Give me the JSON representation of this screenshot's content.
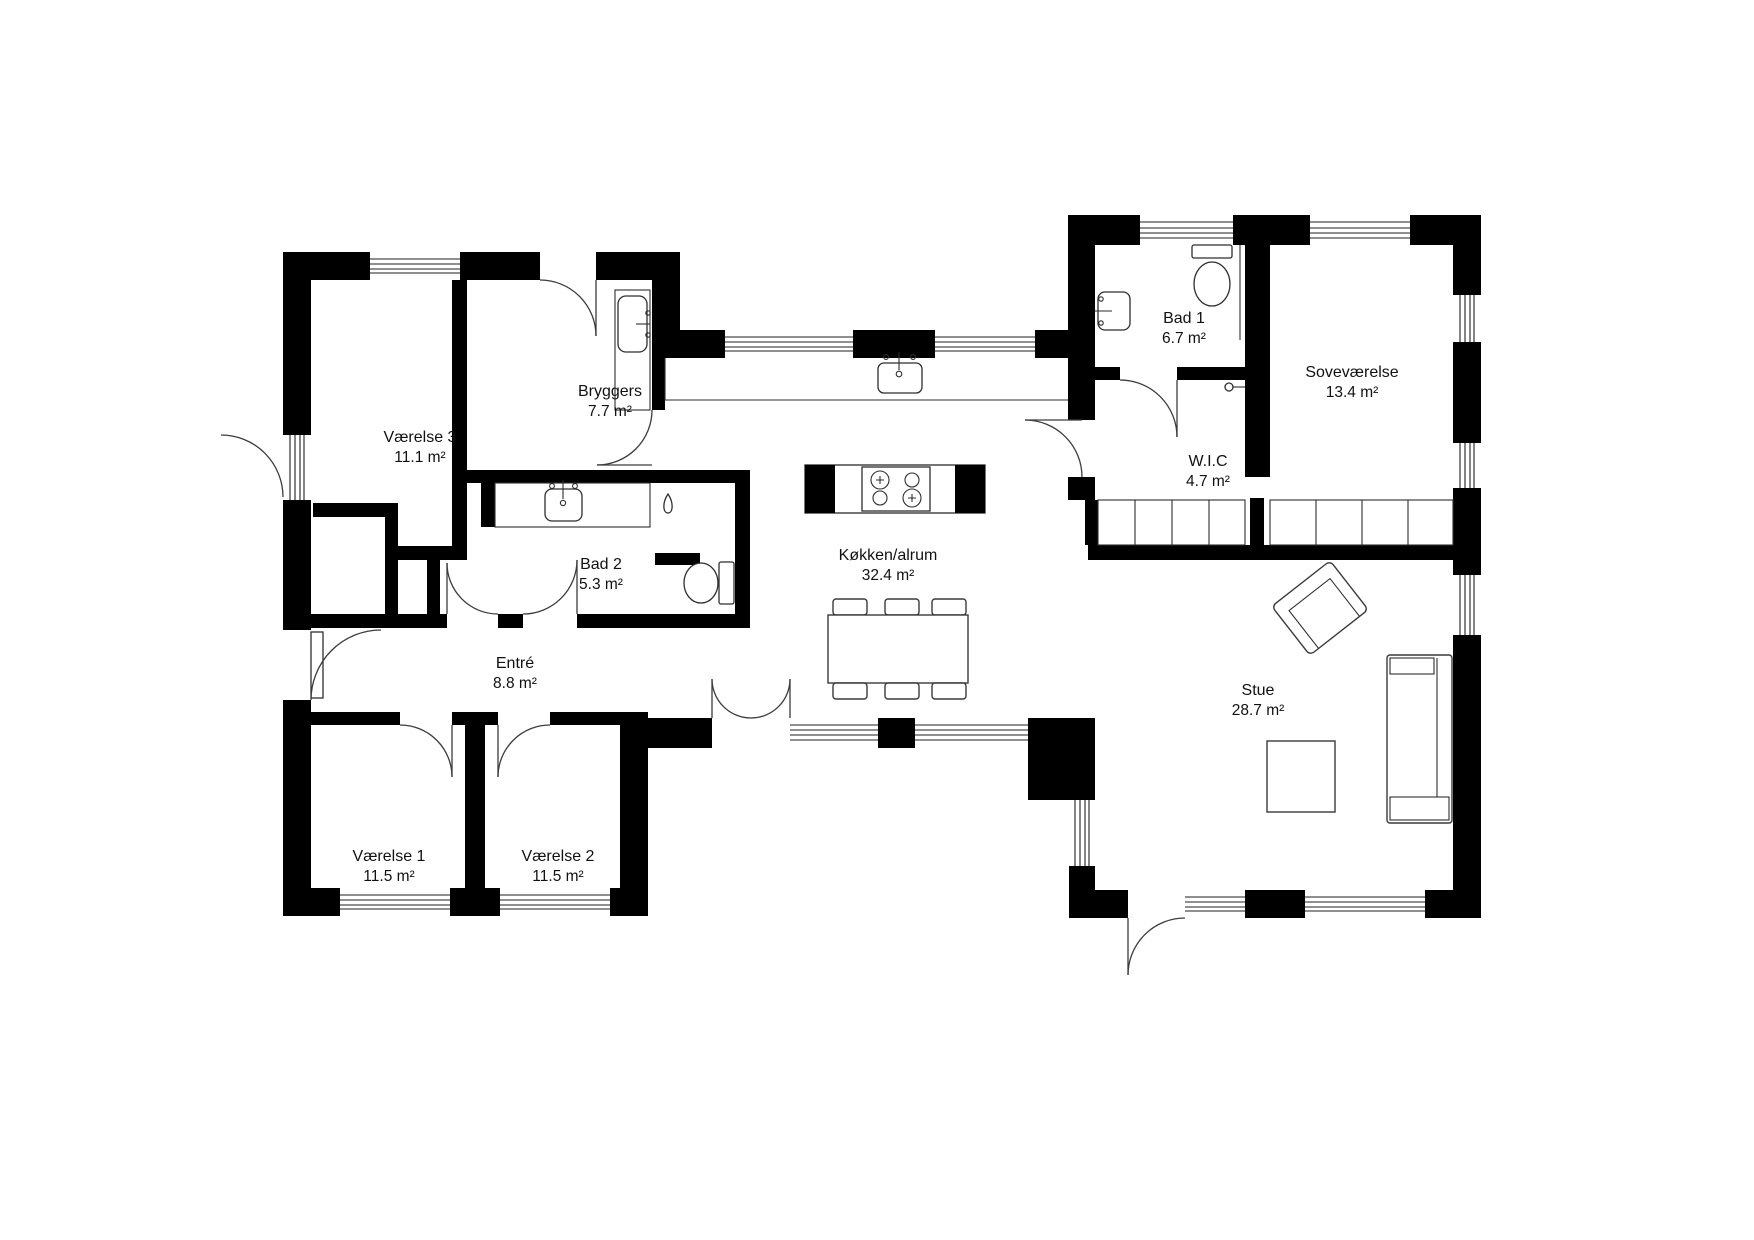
{
  "plan": {
    "title": "Floor plan",
    "wall_color": "#000000",
    "background_color": "#ffffff",
    "unit": "m²",
    "rooms": [
      {
        "id": "vaerelse3",
        "name": "Værelse 3",
        "area": "11.1 m²"
      },
      {
        "id": "bryggers",
        "name": "Bryggers",
        "area": "7.7 m²"
      },
      {
        "id": "bad2",
        "name": "Bad 2",
        "area": "5.3 m²"
      },
      {
        "id": "entre",
        "name": "Entré",
        "area": "8.8 m²"
      },
      {
        "id": "vaerelse1",
        "name": "Værelse 1",
        "area": "11.5 m²"
      },
      {
        "id": "vaerelse2",
        "name": "Værelse 2",
        "area": "11.5 m²"
      },
      {
        "id": "koekken",
        "name": "Køkken/alrum",
        "area": "32.4 m²"
      },
      {
        "id": "bad1",
        "name": "Bad 1",
        "area": "6.7 m²"
      },
      {
        "id": "sovevaerelse",
        "name": "Soveværelse",
        "area": "13.4 m²"
      },
      {
        "id": "wic",
        "name": "W.I.C",
        "area": "4.7 m²"
      },
      {
        "id": "stue",
        "name": "Stue",
        "area": "28.7 m²"
      }
    ],
    "fixtures": [
      "washing-machine",
      "laundry-sink",
      "bathroom-sink",
      "shower-drain",
      "toilet",
      "kitchen-sink",
      "stove-island",
      "dining-table",
      "dining-chairs",
      "wardrobes",
      "armchair",
      "coffee-table",
      "sofa"
    ]
  }
}
